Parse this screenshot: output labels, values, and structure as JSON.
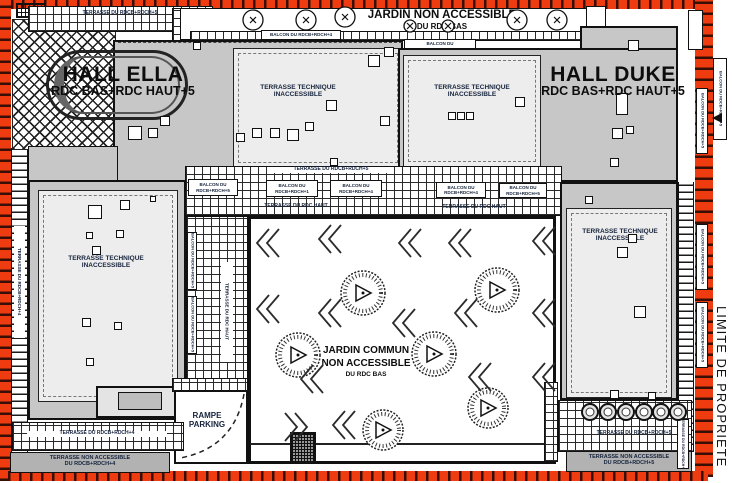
{
  "property": {
    "limit_label": "LIMITE DE PROPRIETE",
    "line_color": "#ee3b10"
  },
  "halls": {
    "ella": {
      "name": "HALL ELLA",
      "levels": "RDC BAS+RDC HAUT+5"
    },
    "duke": {
      "name": "HALL DUKE",
      "levels": "RDC BAS+RDC HAUT+5"
    }
  },
  "gardens": {
    "top": {
      "line1": "JARDIN NON ACCESSIBLE",
      "line2": "DU RDC BAS"
    },
    "central": {
      "line1": "JARDIN COMMUN",
      "line2": "NON ACCESSIBLE",
      "line3": "DU RDC BAS"
    }
  },
  "terraces": {
    "technique": {
      "line1": "TERRASSE TECHNIQUE",
      "line2": "INACCESSIBLE"
    },
    "top_left_strip": "TERRASSE DU RDCB+RDCH+5",
    "mid_strip": "TERRASSE DU RDCB+RDCH+5",
    "rdc_haut": "TERRASSE DU RDC HAUT",
    "bottom_left_strip": "TERRASSE DU RDCB+RDCH+4",
    "bottom_right_strip": "TERRASSE DU RDCB+RDCH+5",
    "left_edge_vertical": "TERRASSE DU RDCB+RDCH+4",
    "non_accessible_4": {
      "line1": "TERRASSE NON ACCESSIBLE",
      "line2": "DU RDCB+RDCH+4"
    },
    "non_accessible_5": {
      "line1": "TERRASSE NON ACCESSIBLE",
      "line2": "DU RDCB+RDCH+5"
    }
  },
  "balconies": {
    "top_strip": "BALCON DU RDCB+RDCH+4",
    "prefix": "BALCON DU",
    "rdc_bas_rdch1": "RDC BAS+RDCH+1",
    "rdcb_rdch5": "RDCB+RDCH+5",
    "rdcb_rdch1": "RDCB+RDCH+1",
    "rdcb_rdch4": "RDCB+RDCH+4",
    "vertical": "BALCON DU RDCB+RDCH+5"
  },
  "parking": {
    "line1": "RAMPE",
    "line2": "PARKING"
  }
}
